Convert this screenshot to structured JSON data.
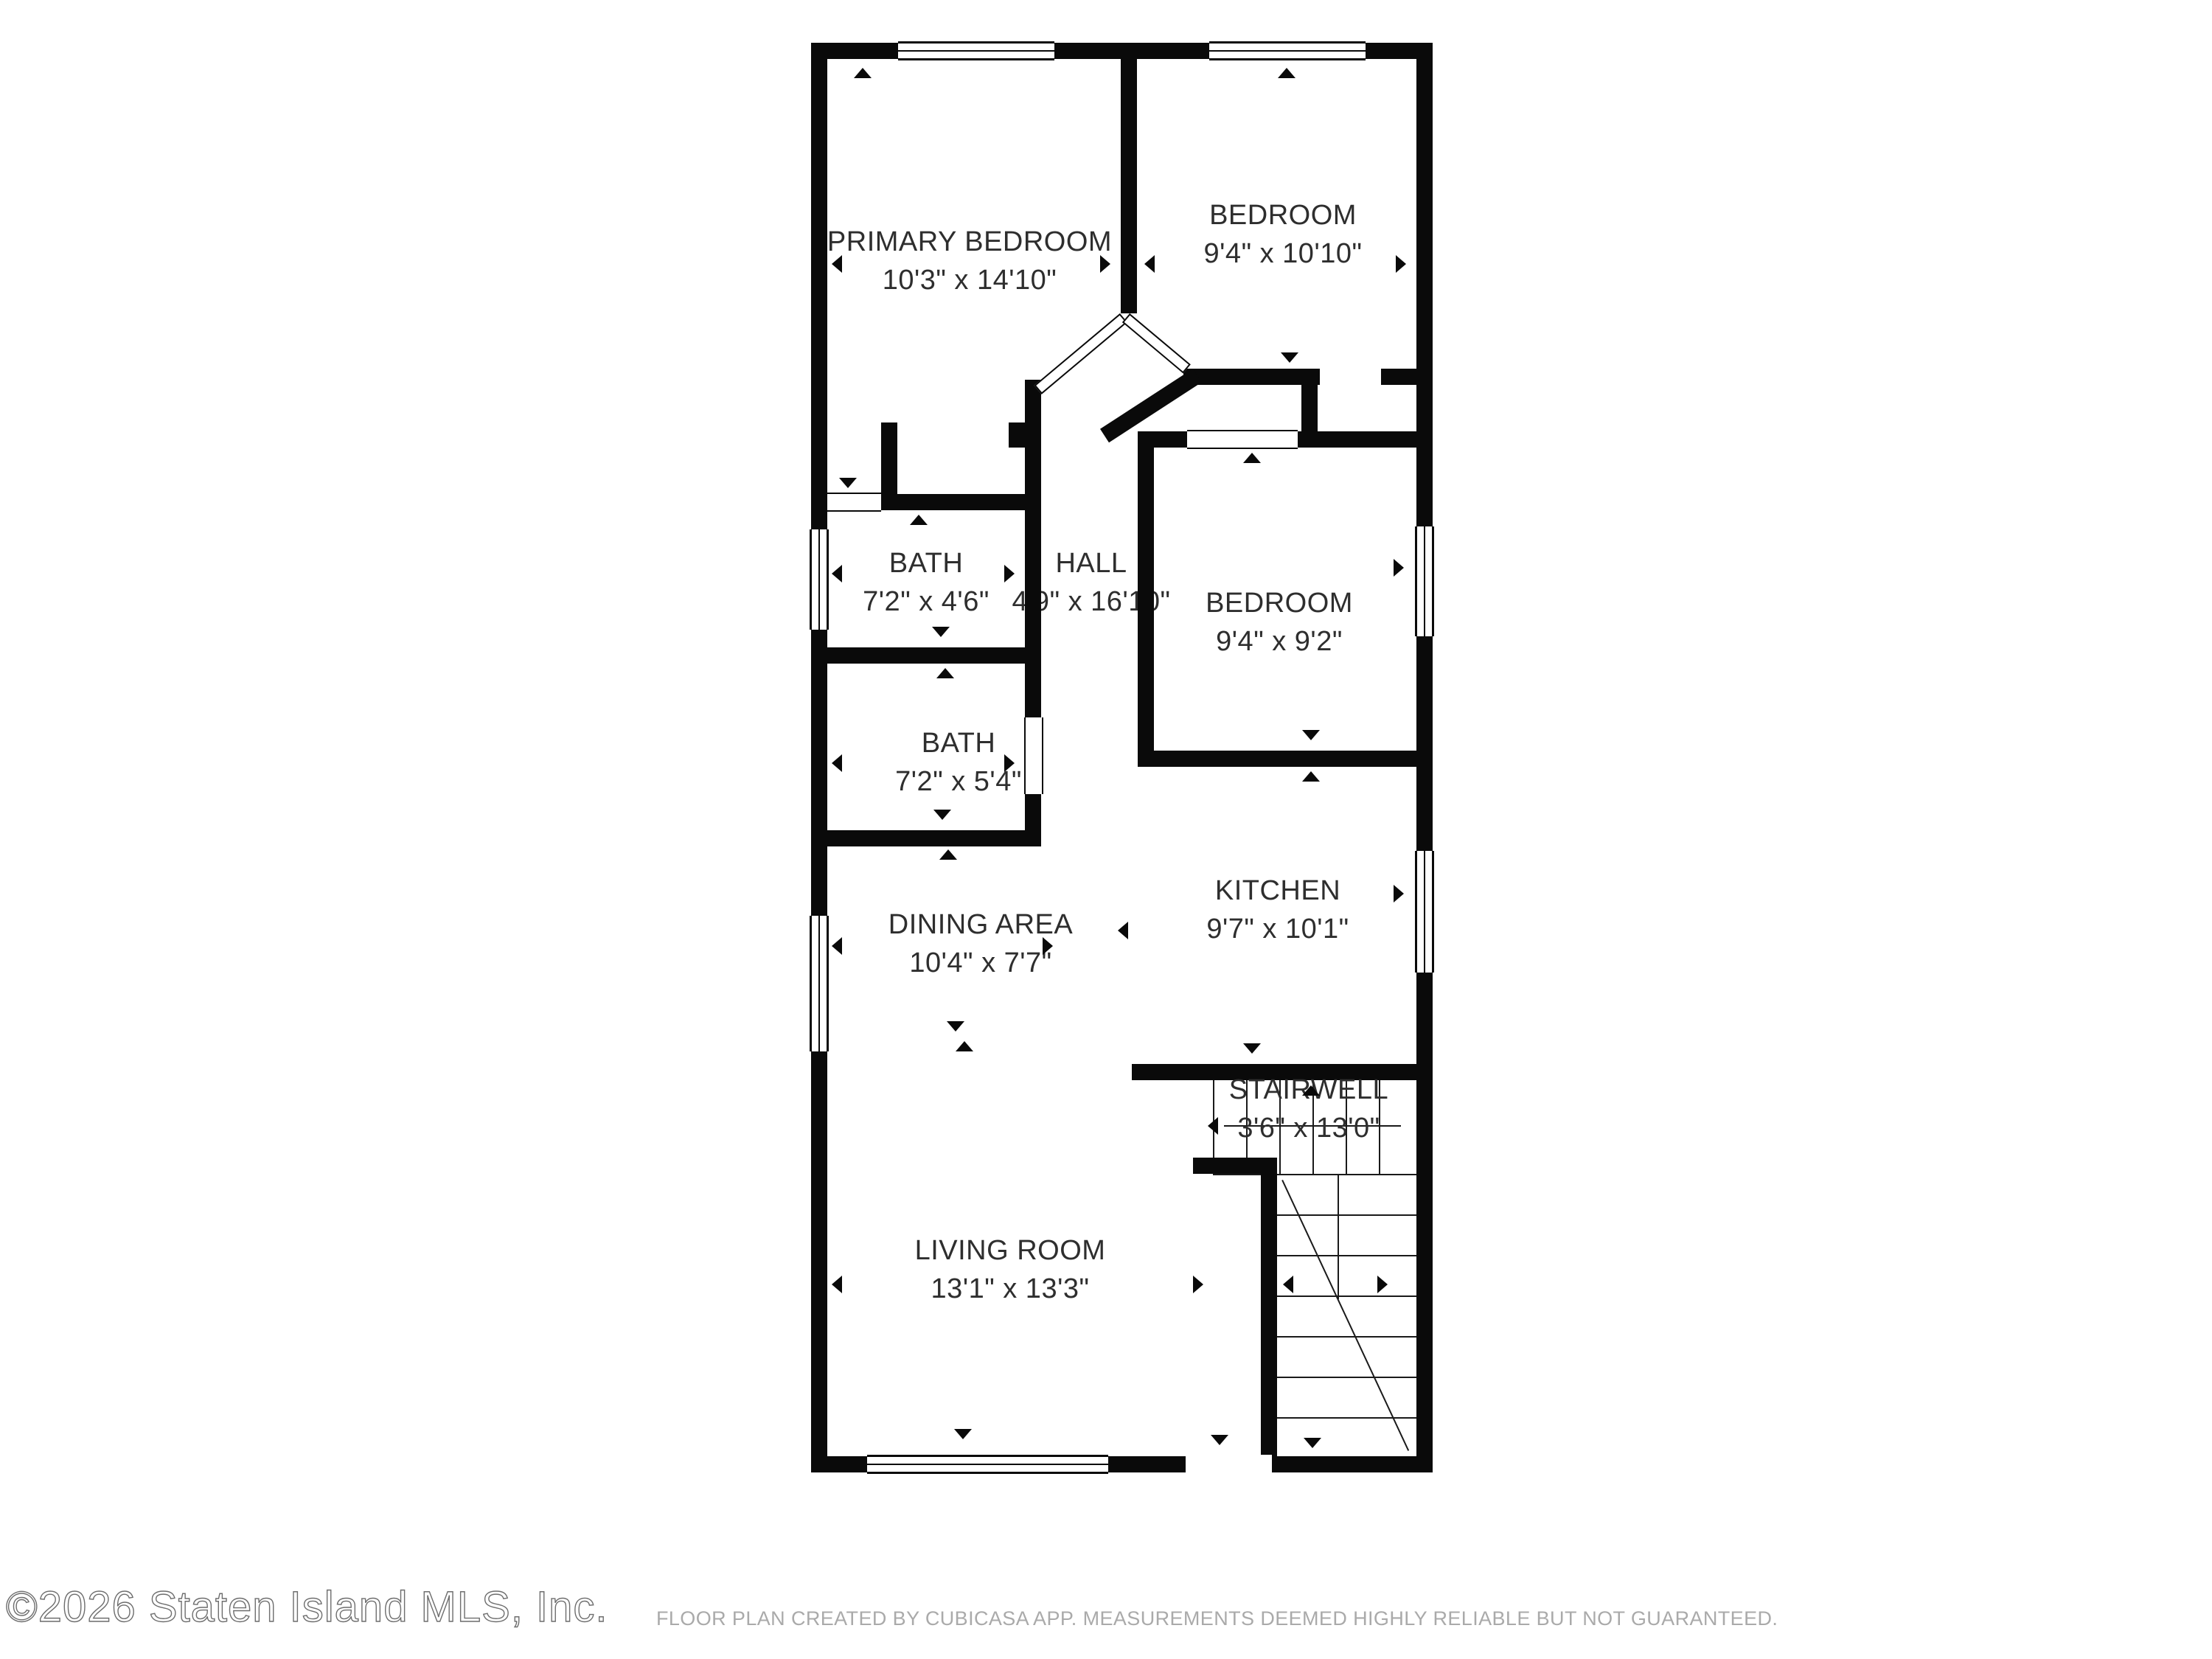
{
  "footer": {
    "copyright": "©2026 Staten Island MLS, Inc.",
    "disclaimer": "FLOOR PLAN CREATED BY CUBICASA APP. MEASUREMENTS DEEMED HIGHLY RELIABLE BUT NOT GUARANTEED."
  },
  "colors": {
    "wall": "#0a0a0a",
    "label_text": "#2e2e2e",
    "copyright_text": "#6e6e6e",
    "disclaimer_text": "#aaaaaa",
    "background": "#ffffff"
  },
  "rooms": [
    {
      "id": "primary-bedroom",
      "name": "PRIMARY BEDROOM",
      "dimensions": "10'3\" x 14'10\""
    },
    {
      "id": "bedroom-top",
      "name": "BEDROOM",
      "dimensions": "9'4\" x 10'10\""
    },
    {
      "id": "bath-upper",
      "name": "BATH",
      "dimensions": "7'2\" x 4'6\""
    },
    {
      "id": "hall",
      "name": "HALL",
      "dimensions": "4'9\" x 16'10\""
    },
    {
      "id": "bedroom-middle",
      "name": "BEDROOM",
      "dimensions": "9'4\" x 9'2\""
    },
    {
      "id": "bath-lower",
      "name": "BATH",
      "dimensions": "7'2\" x 5'4\""
    },
    {
      "id": "dining-area",
      "name": "DINING AREA",
      "dimensions": "10'4\" x 7'7\""
    },
    {
      "id": "kitchen",
      "name": "KITCHEN",
      "dimensions": "9'7\" x 10'1\""
    },
    {
      "id": "stairwell",
      "name": "STAIRWELL",
      "dimensions": "3'6\" x 13'0\""
    },
    {
      "id": "living-room",
      "name": "LIVING ROOM",
      "dimensions": "13'1\" x 13'3\""
    }
  ]
}
